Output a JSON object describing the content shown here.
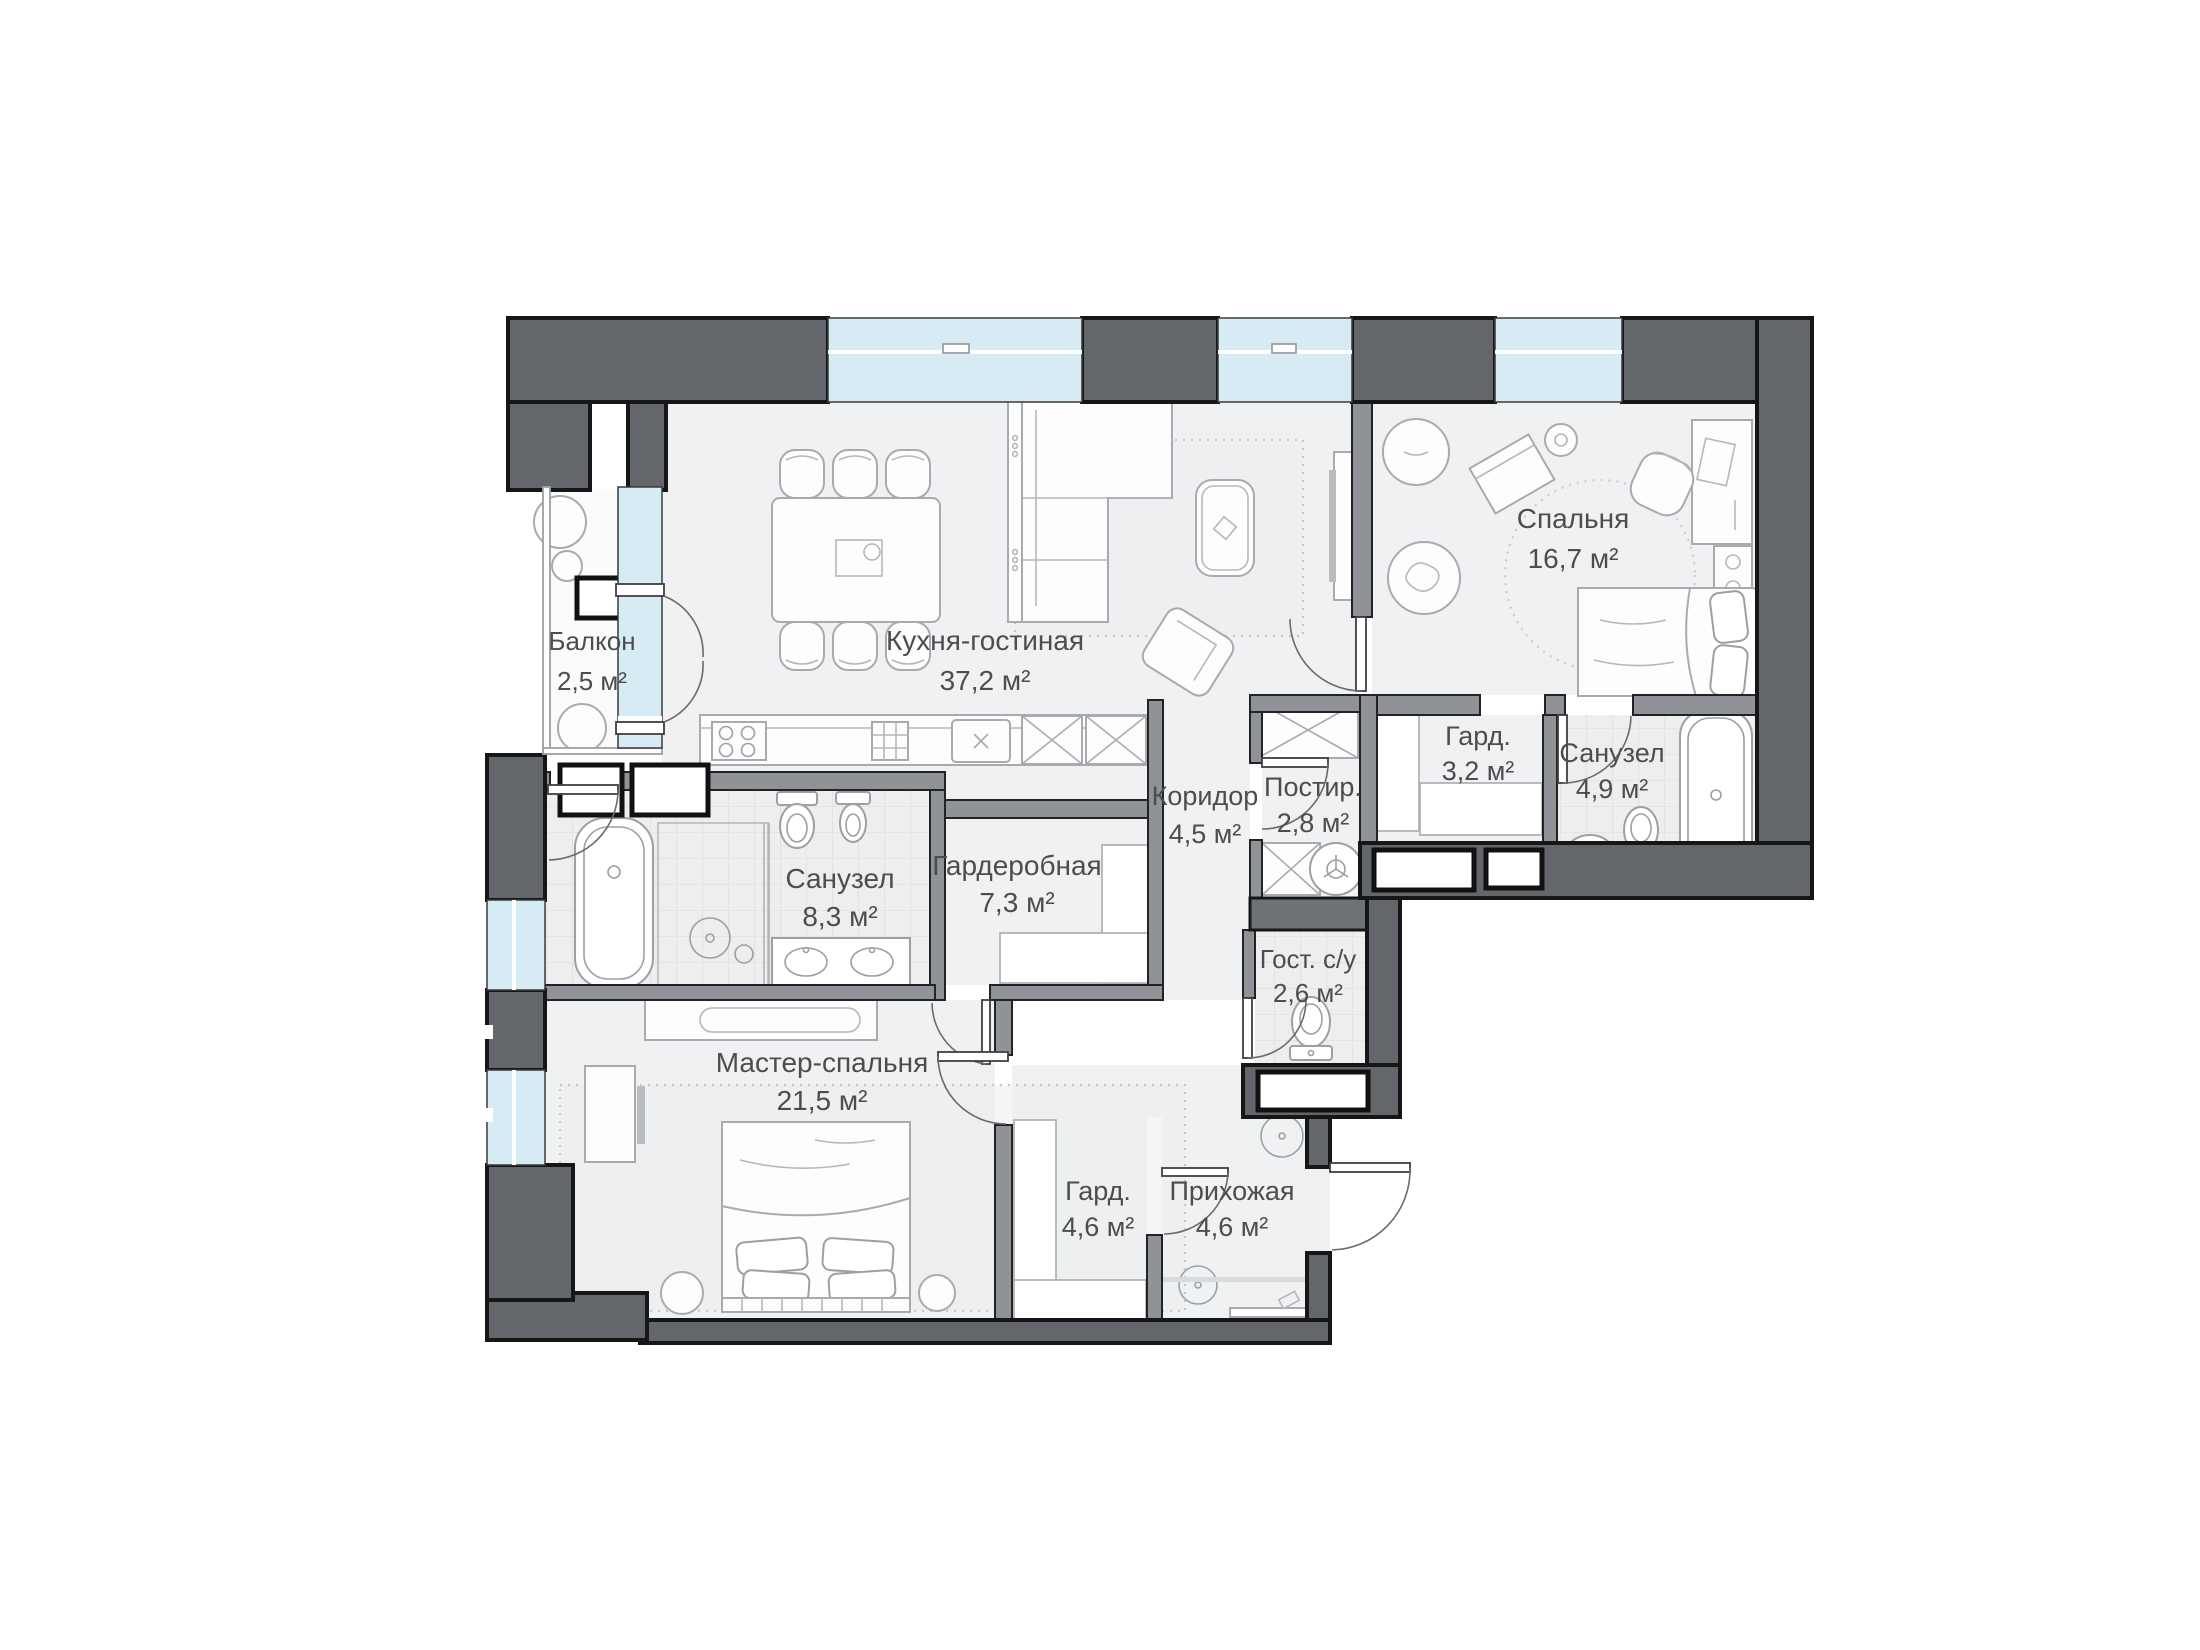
{
  "plan": {
    "type": "apartment-floor-plan",
    "colors": {
      "background": "#ffffff",
      "exterior_wall": "#63676b",
      "interior_wall": "#8f9397",
      "window_glass": "#d6ebf4",
      "floor": "#f0f1f2",
      "label_text": "#4b4d4f"
    },
    "rooms": [
      {
        "id": "balcony",
        "name": "Балкон",
        "area": "2,5 м²"
      },
      {
        "id": "kitchen-living",
        "name": "Кухня-гостиная",
        "area": "37,2 м²"
      },
      {
        "id": "bedroom",
        "name": "Спальня",
        "area": "16,7 м²"
      },
      {
        "id": "wardrobe-bedroom",
        "name": "Гард.",
        "area": "3,2 м²"
      },
      {
        "id": "bathroom-bedroom",
        "name": "Санузел",
        "area": "4,9 м²"
      },
      {
        "id": "corridor",
        "name": "Коридор",
        "area": "4,5 м²"
      },
      {
        "id": "laundry",
        "name": "Постир.",
        "area": "2,8 м²"
      },
      {
        "id": "walkin-closet",
        "name": "Гардеробная",
        "area": "7,3 м²"
      },
      {
        "id": "bathroom-master",
        "name": "Санузел",
        "area": "8,3 м²"
      },
      {
        "id": "guest-wc",
        "name": "Гост. с/у",
        "area": "2,6 м²"
      },
      {
        "id": "master-bedroom",
        "name": "Мастер-спальня",
        "area": "21,5 м²"
      },
      {
        "id": "wardrobe-hall",
        "name": "Гард.",
        "area": "4,6 м²"
      },
      {
        "id": "hallway",
        "name": "Прихожая",
        "area": "4,6 м²"
      }
    ]
  }
}
